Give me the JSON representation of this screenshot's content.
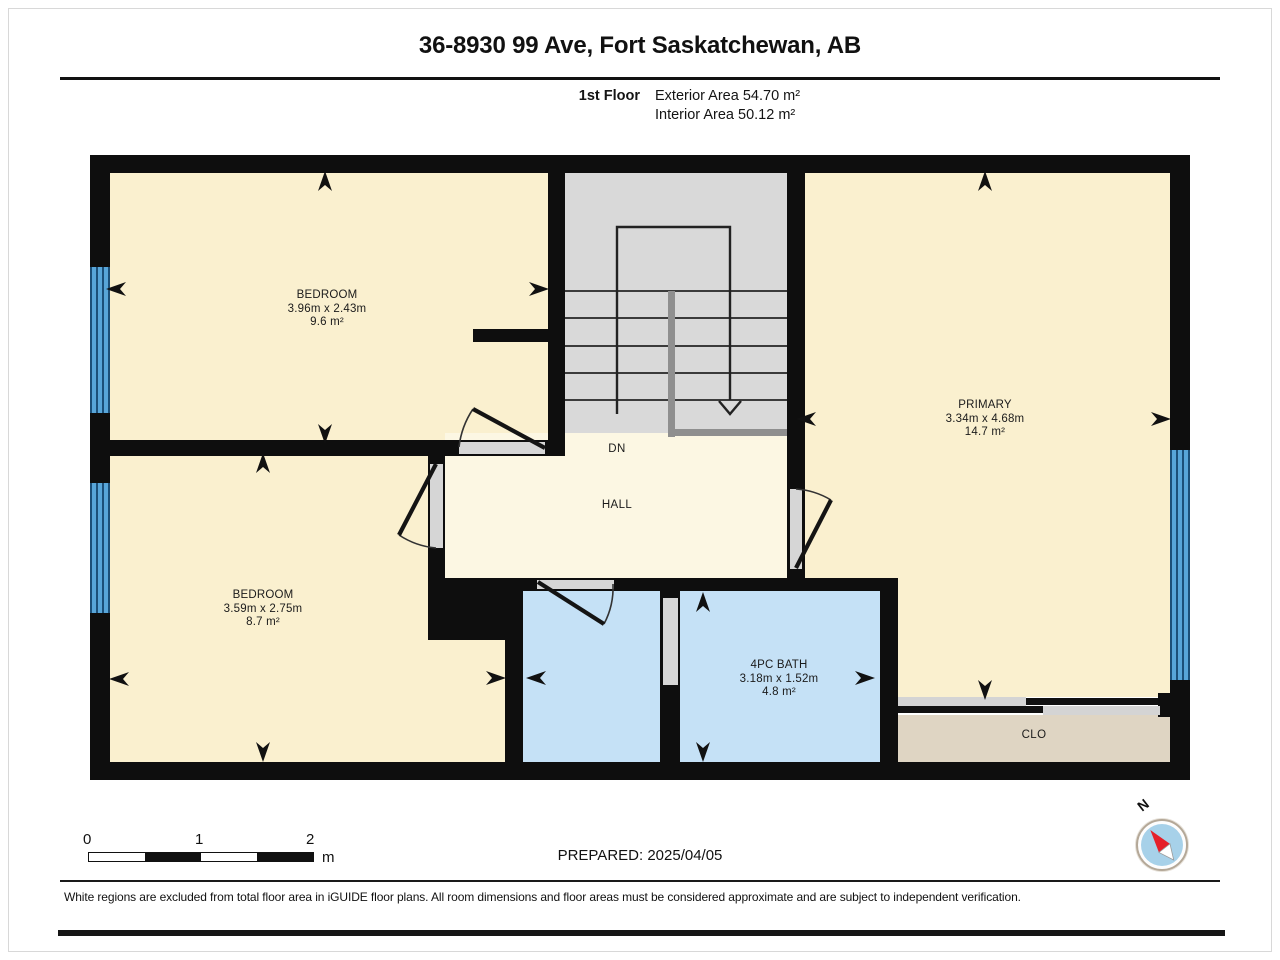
{
  "header": {
    "title": "36-8930 99 Ave, Fort Saskatchewan, AB",
    "floor_label": "1st Floor",
    "exterior_area": "Exterior Area 54.70 m²",
    "interior_area": "Interior Area 50.12 m²"
  },
  "rooms": {
    "bedroom1": {
      "name": "BEDROOM",
      "dims": "3.96m x 2.43m",
      "area": "9.6 m²"
    },
    "bedroom2": {
      "name": "BEDROOM",
      "dims": "3.59m x 2.75m",
      "area": "8.7 m²"
    },
    "primary": {
      "name": "PRIMARY",
      "dims": "3.34m x 4.68m",
      "area": "14.7 m²"
    },
    "bath": {
      "name": "4PC BATH",
      "dims": "3.18m x 1.52m",
      "area": "4.8 m²"
    },
    "hall": {
      "name": "HALL"
    },
    "closet": {
      "name": "CLO"
    },
    "stairs": {
      "down_label": "DN"
    }
  },
  "scale_bar": {
    "tick0": "0",
    "tick1": "1",
    "tick2": "2",
    "unit": "m"
  },
  "prepared": {
    "text": "PREPARED: 2025/04/05"
  },
  "compass": {
    "north_label": "N"
  },
  "footer": {
    "disclaimer": "White regions are excluded from total floor area in iGUIDE floor plans. All room dimensions and floor areas must be considered approximate and are subject to independent verification."
  },
  "palette": {
    "room_cream": "#FAF0CF",
    "hall_cream": "#FCF7E3",
    "wet_room_blue": "#C5E1F6",
    "stairs_gray": "#D9D9D9",
    "closet_beige": "#DFD5C3",
    "window_blue": "#58A5D8",
    "wall_black": "#0E0E0E",
    "compass_red": "#E5202A"
  }
}
